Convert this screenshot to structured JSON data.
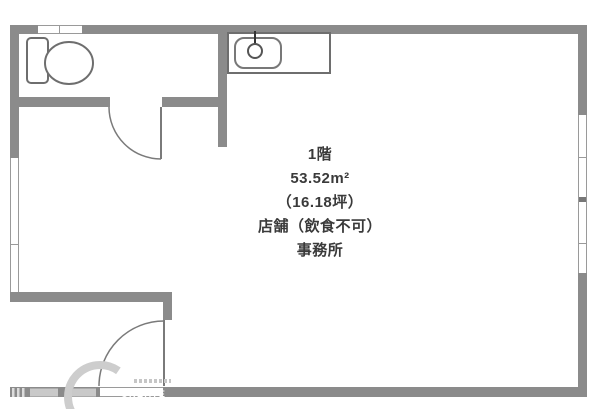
{
  "plan": {
    "info_lines": [
      "1階",
      "53.52m²",
      "（16.18坪）",
      "店舗（飲食不可）",
      "事務所"
    ],
    "watermark_text": "CREATE",
    "fixtures": [
      "toilet",
      "kitchen-sink",
      "faucet"
    ],
    "doors": [
      "toilet-door",
      "entrance-door"
    ],
    "colors": {
      "wall": "#8b8b8b",
      "fixture_stroke": "#6e6e6e",
      "door_stroke": "#7a7a7a",
      "window_line": "#9a9a9a",
      "text": "#3a3a3a",
      "watermark": "#cbcbcb",
      "background": "#ffffff"
    }
  }
}
